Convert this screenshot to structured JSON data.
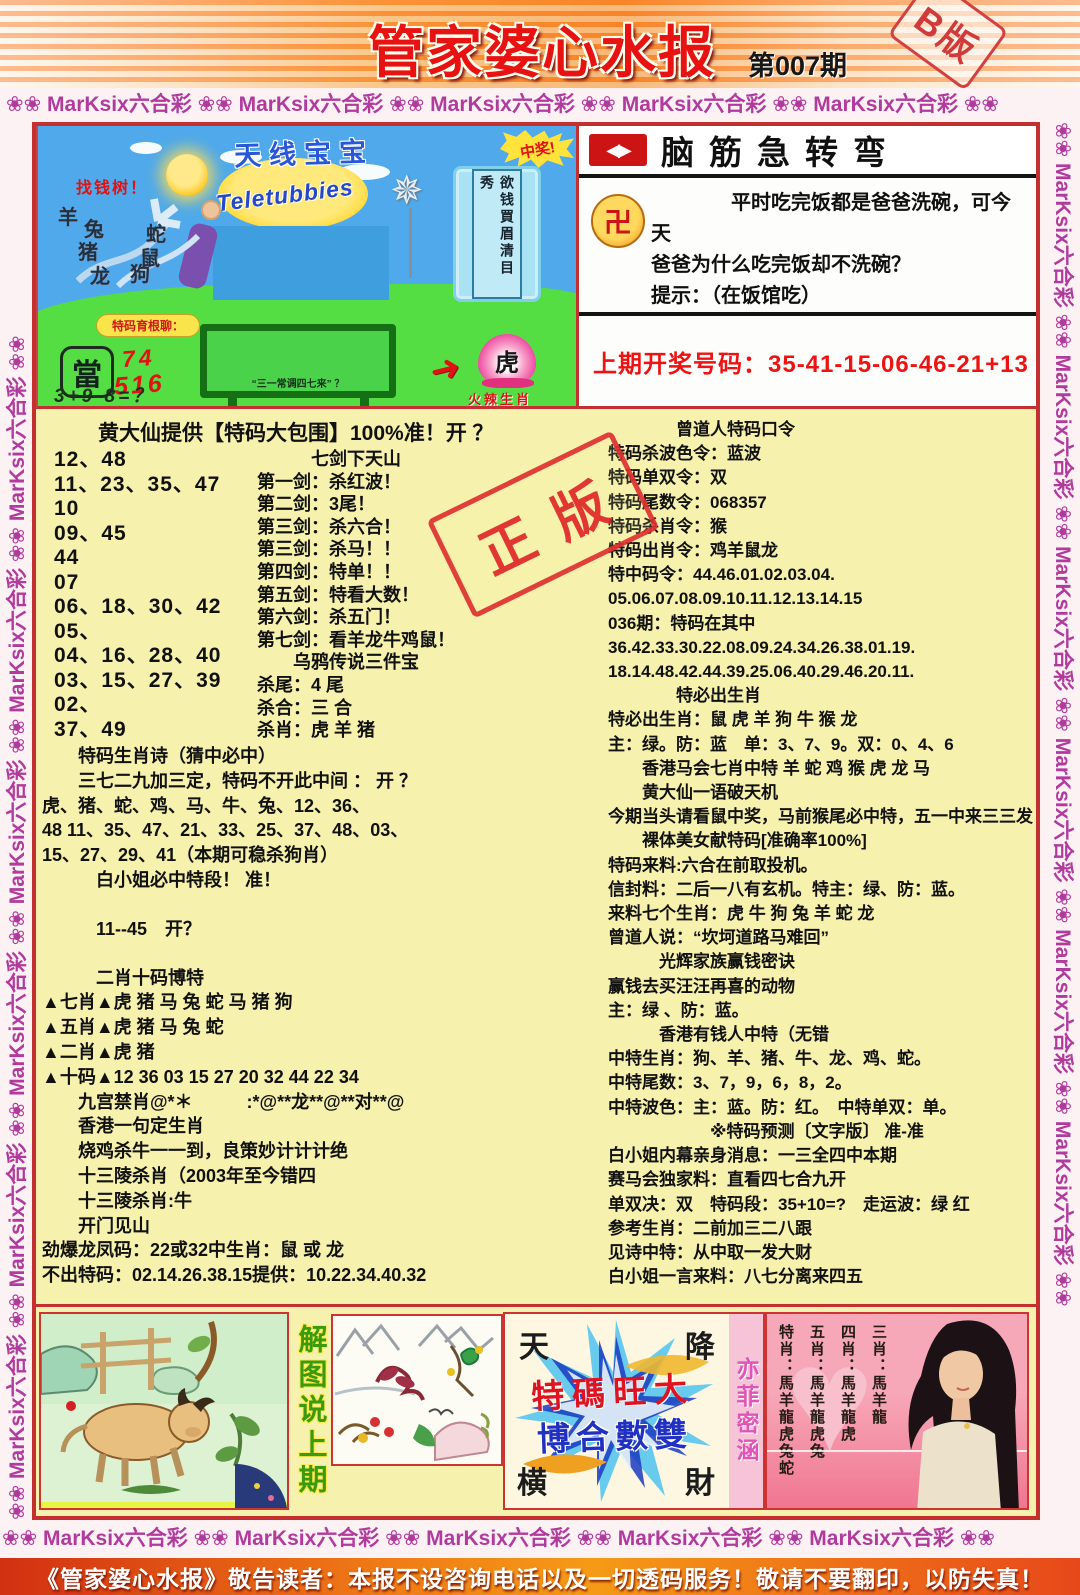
{
  "header": {
    "title": "管家婆心水报",
    "issue": "第007期",
    "edition": "B版"
  },
  "border": {
    "strip_h": "❀❀ MarKsix六合彩 ❀❀ MarKsix六合彩 ❀❀ MarKsix六合彩 ❀❀ MarKsix六合彩 ❀❀ MarKsix六合彩 ❀❀",
    "strip_v": "❀❀ MarKsix六合彩 ❀❀ MarKsix六合彩 ❀❀ MarKsix六合彩 ❀❀ MarKsix六合彩 ❀❀ MarKsix六合彩 ❀❀ MarKsix六合彩 ❀❀"
  },
  "cartoon": {
    "cn_logo": "天线宝宝",
    "en_logo": "Teletubbies",
    "win_burst": "中奖!",
    "banner_vertical": "欲钱買眉清目秀",
    "tree_label": "找钱树！",
    "zodiac": [
      "羊",
      "兔",
      "蛇",
      "猪",
      "鼠",
      "龙",
      "狗"
    ],
    "bubble": "特码育根聊：",
    "dang": "當",
    "num1": "74",
    "num2": "516",
    "formula": "3+9-8=？",
    "board_text": "“三一常调四七来” ？",
    "tiger": "虎",
    "tiger_caption": "火辣生肖"
  },
  "teaser": {
    "title": "脑筋急转弯",
    "logo_glyph": "◀▶",
    "coin_glyph": "卍",
    "question_lines": [
      "　　　　平时吃完饭都是爸爸洗碗，可今天",
      "爸爸为什么吃完饭却不洗碗？",
      "提示：（在饭馆吃）"
    ],
    "last_draw": "上期开奖号码：35-41-15-06-46-21+13"
  },
  "left_column": {
    "headline": "黄大仙提供【特码大包围】100%准！开 ？",
    "numbers": [
      "12、48",
      "11、23、35、47",
      "10",
      "09、45",
      "44",
      "07",
      "06、18、30、42",
      "05、",
      "04、16、28、40",
      "03、15、27、39",
      "02、",
      "37、49"
    ],
    "swords": [
      "　　　七剑下天山",
      "第一剑：杀红波！",
      "第二剑：3尾！",
      "第三剑：杀六合！",
      "第三剑：杀马！！",
      "第四剑：特单！！",
      "第五剑：特看大数！",
      "第六剑：杀五门！",
      "第七剑：看羊龙牛鸡鼠！",
      "　　乌鸦传说三件宝",
      "杀尾：4 尾",
      "杀合：三 合",
      "杀肖：虎 羊 猪"
    ],
    "lines": [
      "　　特码生肖诗（猜中必中）",
      "　　三七二九加三定，特码不开此中间 ： 开 ？",
      "虎、猪、蛇、鸡、马、牛、兔、12、36、",
      "48 11、35、47、21、33、25、37、48、03、",
      "15、27、29、41（本期可稳杀狗肖）",
      "　　　白小姐必中特段！ 准！",
      "",
      "　　　11--45　开？",
      "",
      "　　　二肖十码博特",
      "▲七肖▲虎 猪 马 兔 蛇 马 猪 狗",
      "▲五肖▲虎 猪 马 兔 蛇",
      "▲二肖▲虎 猪",
      "▲十码▲12 36 03 15 27 20 32 44 22 34",
      "　　九宫禁肖@*＊　　　:*@**龙**@**对**@",
      "　　香港一句定生肖",
      "　　烧鸡杀牛一一到，良策妙计计计绝",
      "　　十三陵杀肖（2003年至今错四",
      "　　十三陵杀肖:牛",
      "　　开门见山",
      "劲爆龙凤码：22或32中生肖：鼠 或 龙",
      "不出特码：02.14.26.38.15提供：10.22.34.40.32"
    ]
  },
  "right_column": {
    "lines": [
      "　　　　曾道人特码口令",
      "特码杀波色令：蓝波",
      "特码单双令：双",
      "特码尾数令：068357",
      "特码杀肖令：猴",
      "特码出肖令：鸡羊鼠龙",
      "特中码令：44.46.01.02.03.04.",
      "05.06.07.08.09.10.11.12.13.14.15",
      "036期：特码在其中",
      "36.42.33.30.22.08.09.24.34.26.38.01.19.",
      "18.14.48.42.44.39.25.06.40.29.46.20.11.",
      "　　　　特必出生肖",
      "特必出生肖：鼠 虎 羊 狗 牛 猴 龙",
      "主：绿。防：蓝　单：3、7、9。双：0、4、6",
      "　　香港马会七肖中特 羊 蛇 鸡 猴 虎 龙 马",
      "　　黄大仙一语破天机",
      "今期当头请看鼠中奖，马前猴尾必中特，五一中来三三发",
      "　　裸体美女献特码[准确率100%]",
      "特码来料:六合在前取投机。",
      "信封料：二后一八有玄机。特主：绿、防：蓝。",
      "来料七个生肖：虎 牛 狗 兔 羊 蛇 龙",
      "曾道人说：“坎坷道路马难回”",
      "　　　光辉家族赢钱密诀",
      "赢钱去买汪汪再喜的动物",
      "主：绿 、防：蓝。",
      "　　　香港有钱人中特（无错",
      "中特生肖：狗、羊、猪、牛、龙、鸡、蛇。",
      "中特尾数：3、7，9，6，8，2。",
      "中特波色：主：蓝。防：红。　中特单双：单。",
      "　　　　　　※特码预测〔文字版〕 准-准",
      "白小姐内幕亲身消息：一三全四中本期",
      "赛马会独家料：直看四七合九开",
      "单双决：双　特码段：35+10=?　走运波：绿 红",
      "参考生肖：二前加三二八跟",
      "见诗中特：从中取一发大财",
      "白小姐一言来料：八七分离来四五"
    ]
  },
  "stamp": {
    "text": "正版"
  },
  "bottom": {
    "caption": "解图说上期",
    "burst": {
      "tl": "天",
      "tr": "降",
      "bl": "横",
      "br": "財",
      "line1": "特碼旺大",
      "line2": "博合數雙",
      "side": "亦菲密涵"
    },
    "photo_columns": [
      "特肖：馬羊龍虎兔蛇",
      "五肖：馬羊龍虎兔",
      "四肖：馬羊龍虎",
      "三肖：馬羊龍"
    ]
  },
  "footer": {
    "notice": "《管家婆心水报》敬告读者：本报不设咨询电话以及一切透码服务！敬请不要翻印，以防失真！"
  }
}
